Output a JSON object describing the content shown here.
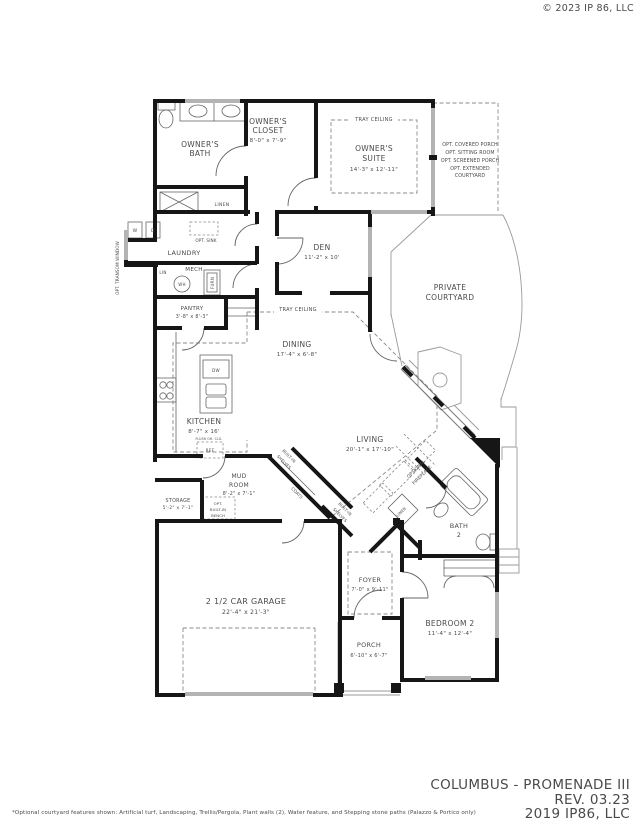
{
  "watermark": "© 2023 IP 86, LLC",
  "rooms": {
    "owners_bath": {
      "line1": "OWNER'S",
      "line2": "BATH"
    },
    "owners_closet": {
      "line1": "OWNER'S",
      "line2": "CLOSET",
      "dims": "8'-0\" x 7'-9\""
    },
    "owners_suite": {
      "line1": "OWNER'S",
      "line2": "SUITE",
      "dims": "14'-3\" x 12'-11\""
    },
    "den": {
      "line1": "DEN",
      "dims": "11'-2\" x 10'"
    },
    "laundry": {
      "line1": "LAUNDRY"
    },
    "mech": {
      "line1": "MECH"
    },
    "pantry": {
      "line1": "PANTRY",
      "dims": "3'-8\" x 8'-3\""
    },
    "dining": {
      "line1": "DINING",
      "dims": "17'-4\" x 6'-8\""
    },
    "kitchen": {
      "line1": "KITCHEN",
      "dims": "8'-7\" x 16'"
    },
    "living": {
      "line1": "LIVING",
      "dims": "20'-1\" x 17'-10\""
    },
    "private_courtyard": {
      "line1": "PRIVATE",
      "line2": "COURTYARD"
    },
    "mud_room": {
      "line1": "MUD",
      "line2": "ROOM",
      "dims": "8'-2\" x 7'-1\""
    },
    "storage": {
      "line1": "STORAGE",
      "dims": "5'-2\" x 7'-1\""
    },
    "garage": {
      "line1": "2 1/2 CAR GARAGE",
      "dims": "22'-4\" x 21'-3\""
    },
    "foyer": {
      "line1": "FOYER",
      "dims": "7'-0\" x 9'-11\""
    },
    "porch": {
      "line1": "PORCH",
      "dims": "6'-10\" x 6'-7\""
    },
    "bedroom2": {
      "line1": "BEDROOM 2",
      "dims": "11'-4\" x 12'-4\""
    },
    "bath2": {
      "line1": "BATH",
      "line2": "2"
    }
  },
  "fixtures": {
    "washer": "W",
    "dryer": "D",
    "water_heater": "WH",
    "furnace": "FURN",
    "dishwasher": "DW",
    "refrigerator": "REF",
    "linen_hall": "LINEN",
    "lin_small": "LIN",
    "linen_bath": "LINEN"
  },
  "annotations": {
    "tray_ceiling_suite": "TRAY CEILING",
    "tray_ceiling_dining": "TRAY CEILING",
    "opt_sink": "OPT. SINK",
    "opt_transom": "OPT. TRANSOM WINDOW",
    "opt_covered_porch": "OPT. COVERED PORCH",
    "opt_sitting_room": "OPT. SITTING ROOM",
    "opt_screened_porch": "OPT. SCREENED PORCH",
    "opt_extended_1": "OPT. EXTENDED",
    "opt_extended_2": "COURTYARD",
    "optional_1": "OPTIONAL",
    "optional_2": "FIREPLACE",
    "builtin1_1": "BUILT-IN",
    "builtin1_2": "SHELVES",
    "builtin2_1": "BUILT-IN",
    "builtin2_2": "SHELVES",
    "coats": "COATS",
    "bench_1": "OPT.",
    "bench_2": "BUILT-IN",
    "bench_3": "BENCH",
    "flush": "FLUSH OH. CLG."
  },
  "title_block": {
    "line1": "COLUMBUS - PROMENADE III",
    "line2": "REV. 03.23",
    "line3": "2019 IP86, LLC"
  },
  "footnote": "*Optional courtyard features shown: Artificial turf, Landscaping, Trellis/Pergola, Plant walls (2), Water feature, and Stepping stone paths (Palazzo & Portico only)",
  "colors": {
    "wall": "#161616",
    "window": "#b3b3b3",
    "title": "#9c9c9c",
    "faint": "#ededed"
  }
}
